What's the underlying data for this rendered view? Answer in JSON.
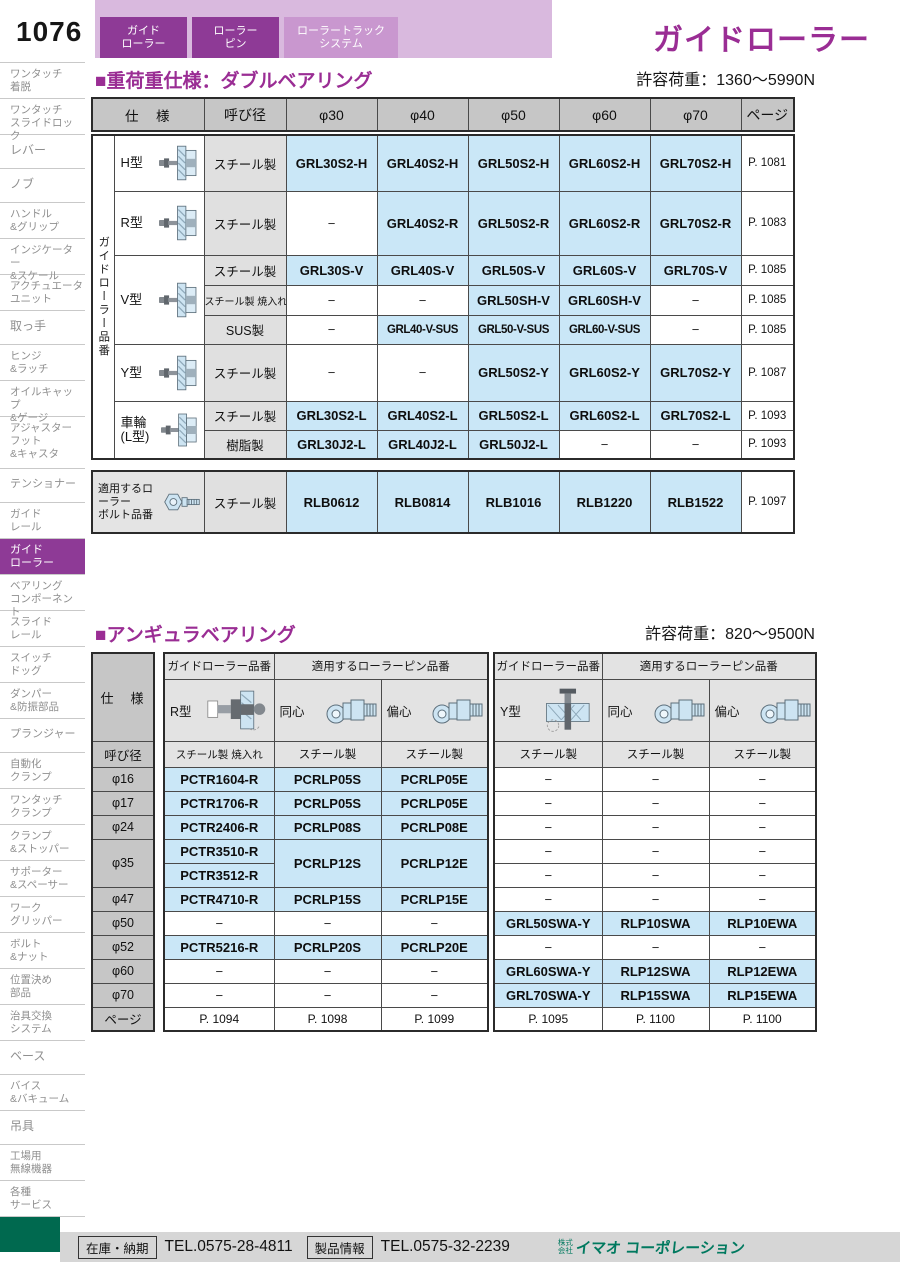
{
  "page": {
    "number": "1076",
    "title": "ガイドローラー"
  },
  "tabs": [
    {
      "label": "ガイド\nローラー"
    },
    {
      "label": "ローラー\nピン"
    },
    {
      "label": "ローラートラック\nシステム"
    }
  ],
  "sidebar": [
    {
      "label": "ワンタッチ\n着脱"
    },
    {
      "label": "ワンタッチ\nスライドロック"
    },
    {
      "label": "レバー"
    },
    {
      "label": "ノブ"
    },
    {
      "label": "ハンドル\n&グリップ"
    },
    {
      "label": "インジケーター\n&スケール"
    },
    {
      "label": "アクチュエータ\nユニット"
    },
    {
      "label": "取っ手"
    },
    {
      "label": "ヒンジ\n&ラッチ"
    },
    {
      "label": "オイルキャップ\n&ゲージ"
    },
    {
      "label": "アジャスター\nフット\n&キャスタ"
    },
    {
      "label": "テンショナー"
    },
    {
      "label": "ガイド\nレール"
    },
    {
      "label": "ガイド\nローラー"
    },
    {
      "label": "ベアリング\nコンポーネント"
    },
    {
      "label": "スライド\nレール"
    },
    {
      "label": "スイッチ\nドッグ"
    },
    {
      "label": "ダンパー\n&防振部品"
    },
    {
      "label": "プランジャー"
    },
    {
      "label": "自動化\nクランプ"
    },
    {
      "label": "ワンタッチ\nクランプ"
    },
    {
      "label": "クランプ\n&ストッパー"
    },
    {
      "label": "サポーター\n&スペーサー"
    },
    {
      "label": "ワーク\nグリッパー"
    },
    {
      "label": "ボルト\n&ナット"
    },
    {
      "label": "位置決め\n部品"
    },
    {
      "label": "治具交換\nシステム"
    },
    {
      "label": "ベース"
    },
    {
      "label": "バイス\n&バキューム"
    },
    {
      "label": "吊具"
    },
    {
      "label": "工場用\n無線機器"
    },
    {
      "label": "各種\nサービス"
    }
  ],
  "section1": {
    "heading": "■重荷重仕様：ダブルベアリング",
    "load": "許容荷重：1360〜5990N"
  },
  "section2": {
    "heading": "■アンギュラベアリング",
    "load": "許容荷重：820〜9500N"
  },
  "t1": {
    "header": [
      "仕　様",
      "呼び径",
      "φ30",
      "φ40",
      "φ50",
      "φ60",
      "φ70",
      "ページ"
    ],
    "side_label": "ガイドローラー品番",
    "rows": [
      {
        "type": "H型",
        "mat": "スチール製",
        "c0": "GRL30S2-H",
        "c1": "GRL40S2-H",
        "c2": "GRL50S2-H",
        "c3": "GRL60S2-H",
        "c4": "GRL70S2-H",
        "page": "P. 1081"
      },
      {
        "type": "R型",
        "mat": "スチール製",
        "c0": "−",
        "c1": "GRL40S2-R",
        "c2": "GRL50S2-R",
        "c3": "GRL60S2-R",
        "c4": "GRL70S2-R",
        "page": "P. 1083"
      },
      {
        "type": "V型",
        "mat": "スチール製",
        "c0": "GRL30S-V",
        "c1": "GRL40S-V",
        "c2": "GRL50S-V",
        "c3": "GRL60S-V",
        "c4": "GRL70S-V",
        "page": "P. 1085"
      },
      {
        "mat": "スチール製 焼入れ",
        "c0": "−",
        "c1": "−",
        "c2": "GRL50SH-V",
        "c3": "GRL60SH-V",
        "c4": "−",
        "page": "P. 1085"
      },
      {
        "mat": "SUS製",
        "c0": "−",
        "c1": "GRL40-V-SUS",
        "c2": "GRL50-V-SUS",
        "c3": "GRL60-V-SUS",
        "c4": "−",
        "page": "P. 1085"
      },
      {
        "type": "Y型",
        "mat": "スチール製",
        "c0": "−",
        "c1": "−",
        "c2": "GRL50S2-Y",
        "c3": "GRL60S2-Y",
        "c4": "GRL70S2-Y",
        "page": "P. 1087"
      },
      {
        "type": "車輪\n(L型)",
        "mat": "スチール製",
        "c0": "GRL30S2-L",
        "c1": "GRL40S2-L",
        "c2": "GRL50S2-L",
        "c3": "GRL60S2-L",
        "c4": "GRL70S2-L",
        "page": "P. 1093"
      },
      {
        "mat": "樹脂製",
        "c0": "GRL30J2-L",
        "c1": "GRL40J2-L",
        "c2": "GRL50J2-L",
        "c3": "−",
        "c4": "−",
        "page": "P. 1093"
      }
    ],
    "bolt": {
      "label": "適用するローラー\nボルト品番",
      "mat": "スチール製",
      "c0": "RLB0612",
      "c1": "RLB0814",
      "c2": "RLB1016",
      "c3": "RLB1220",
      "c4": "RLB1522",
      "page": "P. 1097"
    }
  },
  "t2": {
    "spec_label": "仕　様",
    "dia_label": "呼び径",
    "page_label": "ページ",
    "dias": [
      "φ16",
      "φ17",
      "φ24",
      "φ35",
      "φ47",
      "φ50",
      "φ52",
      "φ60",
      "φ70"
    ],
    "left": {
      "group1": "ガイドローラー品番",
      "group2": "適用するローラーピン品番",
      "type": "R型",
      "pin1": "同心",
      "pin2": "偏心",
      "mat0": "スチール製 焼入れ",
      "mat1": "スチール製",
      "mat2": "スチール製",
      "pg0": "P. 1094",
      "pg1": "P. 1098",
      "pg2": "P. 1099",
      "rows": [
        {
          "a": "PCTR1604-R",
          "b": "PCRLP05S",
          "c": "PCRLP05E"
        },
        {
          "a": "PCTR1706-R",
          "b": "PCRLP05S",
          "c": "PCRLP05E"
        },
        {
          "a": "PCTR2406-R",
          "b": "PCRLP08S",
          "c": "PCRLP08E"
        },
        {
          "a": "PCTR3510-R",
          "b": "PCRLP12S",
          "c": "PCRLP12E"
        },
        {
          "a": "PCTR3512-R"
        },
        {
          "a": "PCTR4710-R",
          "b": "PCRLP15S",
          "c": "PCRLP15E"
        },
        {
          "a": "−",
          "b": "−",
          "c": "−"
        },
        {
          "a": "PCTR5216-R",
          "b": "PCRLP20S",
          "c": "PCRLP20E"
        },
        {
          "a": "−",
          "b": "−",
          "c": "−"
        },
        {
          "a": "−",
          "b": "−",
          "c": "−"
        }
      ]
    },
    "right": {
      "group1": "ガイドローラー品番",
      "group2": "適用するローラーピン品番",
      "type": "Y型",
      "pin1": "同心",
      "pin2": "偏心",
      "mat0": "スチール製",
      "mat1": "スチール製",
      "mat2": "スチール製",
      "pg0": "P. 1095",
      "pg1": "P. 1100",
      "pg2": "P. 1100",
      "rows": [
        {
          "a": "−",
          "b": "−",
          "c": "−"
        },
        {
          "a": "−",
          "b": "−",
          "c": "−"
        },
        {
          "a": "−",
          "b": "−",
          "c": "−"
        },
        {
          "a": "−",
          "b": "−",
          "c": "−"
        },
        {
          "a": "−",
          "b": "−",
          "c": "−"
        },
        {
          "a": "−",
          "b": "−",
          "c": "−"
        },
        {
          "a": "GRL50SWA-Y",
          "b": "RLP10SWA",
          "c": "RLP10EWA"
        },
        {
          "a": "−",
          "b": "−",
          "c": "−"
        },
        {
          "a": "GRL60SWA-Y",
          "b": "RLP12SWA",
          "c": "RLP12EWA"
        },
        {
          "a": "GRL70SWA-Y",
          "b": "RLP15SWA",
          "c": "RLP15EWA"
        }
      ]
    }
  },
  "footer": {
    "stock_label": "在庫・納期",
    "stock_tel": "TEL.0575-28-4811",
    "product_label": "製品情報",
    "product_tel": "TEL.0575-32-2239",
    "company_prefix": "株式\n会社",
    "company": "イマオ コーポレーション"
  },
  "colors": {
    "accent_purple": "#9a2d94",
    "tab_purple": "#8e3a96",
    "tab_strip": "#d9b9de",
    "tab_inactive": "#c997cf",
    "cell_blue": "#cae7f7",
    "header_gray": "#c6c6c6",
    "logo_green": "#00795f",
    "footer_green_block": "#00694f"
  }
}
